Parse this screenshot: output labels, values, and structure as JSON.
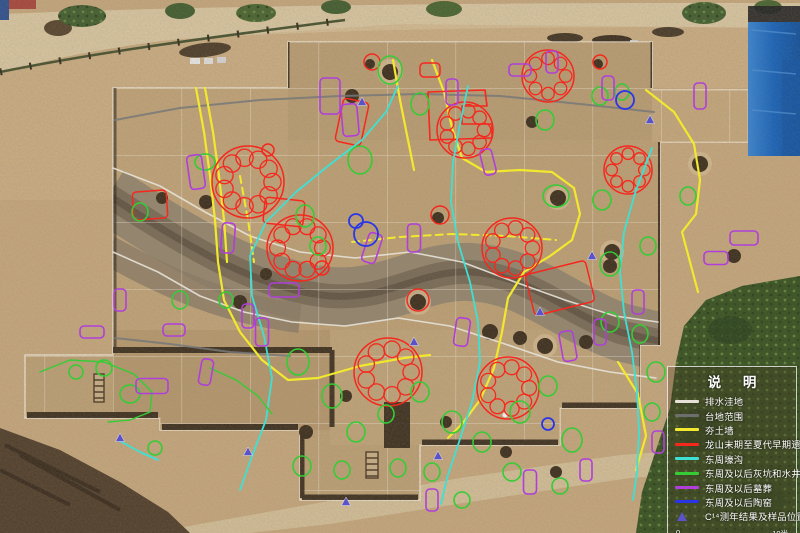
{
  "legend": {
    "title": "说 明",
    "items": [
      {
        "id": "drainage",
        "label": "排水洼地",
        "swatch": "line",
        "color": "#e6e2d8"
      },
      {
        "id": "terrace",
        "label": "台地范围",
        "swatch": "line",
        "color": "#6e6e6e"
      },
      {
        "id": "wall",
        "label": "夯土墙",
        "swatch": "line",
        "color": "#f2e82e"
      },
      {
        "id": "longshan",
        "label": "龙山末期至夏代早期遗迹",
        "swatch": "line",
        "color": "#f5281e"
      },
      {
        "id": "moat",
        "label": "东周壕沟",
        "swatch": "line",
        "color": "#3fe0d4"
      },
      {
        "id": "pits",
        "label": "东周及以后灰坑和水井",
        "swatch": "line",
        "color": "#35cc35"
      },
      {
        "id": "tombs",
        "label": "东周及以后墓葬",
        "swatch": "line",
        "color": "#b03fd9"
      },
      {
        "id": "kilns",
        "label": "东周及以后陶窑",
        "swatch": "line",
        "color": "#2a35e8"
      },
      {
        "id": "c14",
        "label": "C¹⁴测年结果及样品位置",
        "swatch": "triangle",
        "color": "#5a52c8"
      }
    ],
    "scale_bar": {
      "left_label": "0",
      "right_label": "10米"
    }
  },
  "annotations": {
    "colors": {
      "drainage": "#e6e2d8",
      "terrace": "#787878",
      "wall": "#f2e82e",
      "longshan": "#f5281e",
      "moat": "#3fe0d4",
      "pits": "#35cc35",
      "tombs": "#b03fd9",
      "kilns": "#2a35e8",
      "c14": "#5a52c8"
    },
    "drainage_lines": [
      "113,168 160,186 205,212 250,236 300,252 355,258 410,252 462,262 515,282 565,300 615,316 658,322",
      "113,252 158,272 200,296 244,312 292,322 345,326 398,318 450,326 505,344 558,362 610,372 656,378"
    ],
    "terrace_lines": [
      "115,120 180,108 260,100 340,96 420,94 500,96 580,104 654,112",
      "115,338 170,344 230,352 290,356"
    ],
    "wall_lines": [
      "196,88 204,132 210,176 215,220 218,262 224,300 240,332 262,360 288,380 318,378 360,366 404,358 430,355",
      "205,88 213,132 219,176 224,220 227,262",
      "432,60 444,92 452,128 462,158 486,172 520,170 552,172 574,188 580,214 572,240 550,256 524,272 508,298 502,332 494,368 480,400 462,424 448,438",
      "646,90 674,112 694,144 700,180 696,214 682,232 690,262 698,292",
      "618,362 638,394 646,436 636,470",
      "393,60 400,100 408,140 414,170"
    ],
    "wall_dashed_lines": [
      "352,242 400,237 452,234 506,236 556,240",
      "240,176 248,220 254,262"
    ],
    "moat_lines": [
      "398,86 386,112 362,140 328,166 296,192 266,222 250,256 252,296 264,336 272,378 266,420 252,456 240,490",
      "468,86 460,124 453,162 451,202 458,242 470,282 478,322 480,362 472,402 459,442 447,478 441,504",
      "652,148 636,190 624,232 620,272 624,312 632,352 637,392 639,432 637,472 633,500",
      "118,440 140,452 158,460"
    ],
    "red_rings": [
      [
        248,
        182,
        36,
        11
      ],
      [
        300,
        248,
        33,
        10
      ],
      [
        465,
        130,
        28,
        9
      ],
      [
        512,
        248,
        30,
        9
      ],
      [
        548,
        76,
        26,
        8
      ],
      [
        628,
        170,
        24,
        8
      ],
      [
        388,
        372,
        34,
        9
      ],
      [
        508,
        388,
        31,
        9
      ]
    ],
    "red_rects": [
      [
        352,
        122,
        26,
        44,
        12
      ],
      [
        150,
        205,
        34,
        28,
        -4
      ],
      [
        560,
        288,
        62,
        42,
        -14
      ],
      [
        284,
        212,
        40,
        26,
        6
      ],
      [
        430,
        70,
        20,
        14,
        0
      ]
    ],
    "red_circles": [
      [
        418,
        300,
        11
      ],
      [
        440,
        215,
        9
      ],
      [
        372,
        62,
        8
      ],
      [
        600,
        62,
        7
      ],
      [
        322,
        268,
        7
      ],
      [
        268,
        150,
        6
      ]
    ],
    "red_paths": [
      "428,92 485,90 487,106 462,106 462,124 492,124 492,138 430,140 428,92"
    ],
    "green_ellipses": [
      [
        390,
        70,
        12,
        14
      ],
      [
        420,
        104,
        9,
        11
      ],
      [
        360,
        160,
        12,
        14
      ],
      [
        305,
        216,
        9,
        11
      ],
      [
        318,
        246,
        8,
        9
      ],
      [
        205,
        162,
        10,
        8
      ],
      [
        140,
        212,
        8,
        9
      ],
      [
        545,
        120,
        9,
        10
      ],
      [
        600,
        96,
        8,
        9
      ],
      [
        622,
        92,
        7,
        8
      ],
      [
        556,
        196,
        13,
        11
      ],
      [
        602,
        200,
        9,
        10
      ],
      [
        610,
        264,
        10,
        12
      ],
      [
        648,
        246,
        8,
        9
      ],
      [
        688,
        196,
        8,
        9
      ],
      [
        298,
        362,
        11,
        13
      ],
      [
        332,
        396,
        10,
        12
      ],
      [
        356,
        432,
        9,
        10
      ],
      [
        386,
        414,
        8,
        9
      ],
      [
        420,
        392,
        9,
        10
      ],
      [
        452,
        422,
        10,
        11
      ],
      [
        482,
        442,
        9,
        10
      ],
      [
        520,
        412,
        10,
        11
      ],
      [
        548,
        386,
        9,
        10
      ],
      [
        572,
        440,
        10,
        12
      ],
      [
        302,
        466,
        9,
        10
      ],
      [
        342,
        470,
        8,
        9
      ],
      [
        398,
        468,
        8,
        9
      ],
      [
        432,
        472,
        8,
        9
      ],
      [
        462,
        500,
        8,
        8
      ],
      [
        512,
        472,
        9,
        9
      ],
      [
        560,
        486,
        8,
        8
      ],
      [
        610,
        322,
        9,
        10
      ],
      [
        640,
        334,
        8,
        9
      ],
      [
        656,
        372,
        9,
        10
      ],
      [
        652,
        412,
        8,
        9
      ],
      [
        130,
        394,
        10,
        9
      ],
      [
        104,
        368,
        8,
        8
      ],
      [
        76,
        372,
        7,
        7
      ],
      [
        180,
        300,
        8,
        9
      ],
      [
        226,
        300,
        7,
        8
      ],
      [
        155,
        448,
        7,
        7
      ]
    ],
    "green_lines": [
      "40,372 70,360 104,362 134,374 152,392 150,412 130,420 108,422",
      "210,368 236,380 258,396 272,414"
    ],
    "purple_rects": [
      [
        196,
        172,
        15,
        34,
        -8
      ],
      [
        228,
        238,
        13,
        30,
        4
      ],
      [
        262,
        332,
        13,
        28,
        0
      ],
      [
        152,
        386,
        32,
        15,
        0
      ],
      [
        206,
        372,
        12,
        26,
        10
      ],
      [
        92,
        332,
        24,
        12,
        0
      ],
      [
        350,
        120,
        16,
        32,
        -5
      ],
      [
        372,
        248,
        14,
        30,
        18
      ],
      [
        452,
        92,
        12,
        26,
        0
      ],
      [
        520,
        70,
        22,
        12,
        0
      ],
      [
        608,
        88,
        12,
        24,
        0
      ],
      [
        700,
        96,
        12,
        26,
        0
      ],
      [
        744,
        238,
        28,
        14,
        0
      ],
      [
        716,
        258,
        24,
        13,
        0
      ],
      [
        568,
        346,
        14,
        30,
        -10
      ],
      [
        600,
        332,
        12,
        26,
        0
      ],
      [
        638,
        302,
        12,
        24,
        0
      ],
      [
        488,
        162,
        12,
        26,
        -14
      ],
      [
        284,
        290,
        30,
        14,
        0
      ],
      [
        462,
        332,
        14,
        28,
        8
      ],
      [
        432,
        500,
        12,
        22,
        0
      ],
      [
        530,
        482,
        13,
        24,
        0
      ],
      [
        586,
        470,
        12,
        22,
        0
      ],
      [
        658,
        442,
        12,
        22,
        0
      ],
      [
        248,
        316,
        12,
        24,
        0
      ],
      [
        330,
        96,
        20,
        36,
        0
      ],
      [
        414,
        238,
        13,
        28,
        0
      ],
      [
        552,
        62,
        12,
        22,
        0
      ],
      [
        120,
        300,
        12,
        22,
        0
      ],
      [
        174,
        330,
        22,
        12,
        0
      ]
    ],
    "blue_circles": [
      [
        366,
        234,
        12
      ],
      [
        356,
        221,
        7
      ],
      [
        625,
        100,
        9
      ],
      [
        548,
        424,
        6
      ]
    ],
    "c14_points": [
      [
        362,
        102
      ],
      [
        650,
        120
      ],
      [
        592,
        256
      ],
      [
        438,
        456
      ],
      [
        346,
        502
      ],
      [
        248,
        452
      ],
      [
        120,
        438
      ],
      [
        540,
        312
      ],
      [
        414,
        342
      ]
    ]
  }
}
